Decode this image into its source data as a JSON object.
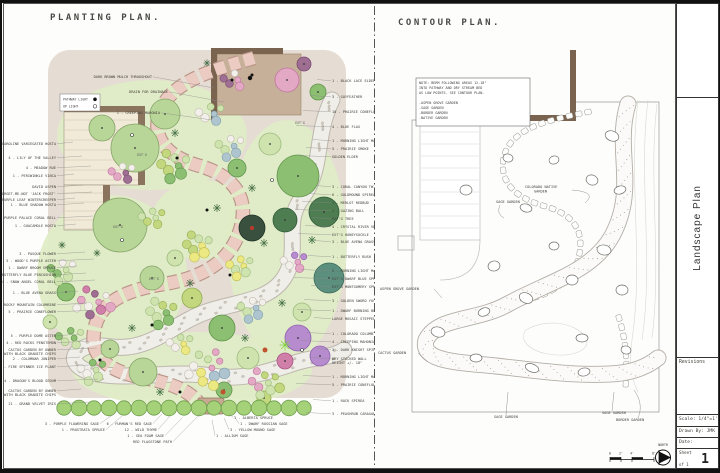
{
  "title_block": {
    "project": "Landscape Plan",
    "revisions_label": "Revisions",
    "scale_label": "Scale:  1/4\"=1'",
    "drawn_by_label": "Drawn By:  JMK",
    "date_label": "Date:",
    "sheet_label": "Sheet",
    "sheet_number": "1",
    "of_label": "of 1",
    "north_label": "NORTH",
    "scale_bar_labels": [
      "0",
      "2'",
      "4'",
      "8'"
    ]
  },
  "planting_plan": {
    "title": "PLANTING PLAN.",
    "legend": {
      "items": [
        {
          "label": "PATHWAY LIGHT",
          "symbol": "filled-dot"
        },
        {
          "label": "UP LIGHT",
          "symbol": "open-dot"
        }
      ]
    },
    "palette": {
      "aspen": [
        "#b9d699",
        "#85a468"
      ],
      "pale": [
        "#cfe3ae",
        "#9cbb7d"
      ],
      "mid": [
        "#8cbf72",
        "#5f9449"
      ],
      "deep": [
        "#4e7d52",
        "#2f5a38"
      ],
      "teal": [
        "#5d8f7e",
        "#3a6b5a"
      ],
      "ygreen": [
        "#c2d77e",
        "#93ad52"
      ],
      "yellow": [
        "#ece983",
        "#c2bb4f"
      ],
      "bgray": [
        "#aec4cf",
        "#7fa0b0"
      ],
      "pink": [
        "#e3a8c4",
        "#c075a0"
      ],
      "pinkDeep": [
        "#cf7fa8",
        "#a85585"
      ],
      "plum": [
        "#9f6f93",
        "#7a4a70"
      ],
      "purple": [
        "#b68cce",
        "#8f60ad"
      ],
      "white": [
        "#f3f0ec",
        "#c2bcb2"
      ],
      "ball": [
        "#39503f",
        "#1f3528"
      ],
      "hedge": [
        "#a5d178",
        "#6f9e4c"
      ]
    },
    "plants": [
      [
        133,
        108,
        24,
        "aspen"
      ],
      [
        163,
        74,
        15,
        "aspen"
      ],
      [
        100,
        88,
        13,
        "aspen"
      ],
      [
        118,
        185,
        27,
        "aspen"
      ],
      [
        150,
        238,
        12,
        "aspen"
      ],
      [
        141,
        332,
        14,
        "aspen"
      ],
      [
        108,
        309,
        9,
        "aspen"
      ],
      [
        296,
        136,
        21,
        "mid"
      ],
      [
        268,
        104,
        11,
        "pale"
      ],
      [
        322,
        172,
        15,
        "deep"
      ],
      [
        283,
        180,
        12,
        "deep"
      ],
      [
        327,
        238,
        15,
        "teal"
      ],
      [
        235,
        128,
        9,
        "mid"
      ],
      [
        250,
        188,
        13,
        "ball"
      ],
      [
        296,
        298,
        13,
        "purple"
      ],
      [
        318,
        316,
        10,
        "purple"
      ],
      [
        283,
        321,
        8,
        "pinkDeep"
      ],
      [
        300,
        272,
        9,
        "pale"
      ],
      [
        285,
        40,
        12,
        "pink"
      ],
      [
        302,
        24,
        7,
        "plum"
      ],
      [
        316,
        52,
        8,
        "mid"
      ],
      [
        220,
        288,
        13,
        "mid"
      ],
      [
        246,
        318,
        11,
        "pale"
      ],
      [
        190,
        258,
        10,
        "ygreen"
      ],
      [
        173,
        218,
        8,
        "pale"
      ],
      [
        64,
        252,
        9,
        "mid"
      ],
      [
        48,
        282,
        7,
        "pale"
      ],
      [
        222,
        350,
        8,
        "mid"
      ],
      [
        262,
        358,
        7,
        "ygreen"
      ]
    ],
    "clusters": [
      [
        208,
        74,
        6,
        13,
        3,
        5,
        [
          "bgray",
          "white",
          "pale"
        ]
      ],
      [
        172,
        126,
        8,
        17,
        3.5,
        6,
        [
          "mid",
          "ygreen",
          "pale"
        ]
      ],
      [
        228,
        106,
        7,
        14,
        3,
        5,
        [
          "bgray",
          "pale",
          "white"
        ]
      ],
      [
        196,
        206,
        8,
        15,
        3.5,
        5.5,
        [
          "yellow",
          "ygreen",
          "pale"
        ]
      ],
      [
        238,
        226,
        7,
        13,
        3,
        5,
        [
          "yellow",
          "pale"
        ]
      ],
      [
        92,
        262,
        10,
        19,
        3,
        5,
        [
          "pink",
          "white",
          "plum",
          "pinkDeep"
        ]
      ],
      [
        60,
        230,
        7,
        14,
        3,
        5,
        [
          "pale",
          "mid",
          "white"
        ]
      ],
      [
        160,
        273,
        8,
        16,
        3.5,
        5.5,
        [
          "mid",
          "pale",
          "ygreen"
        ]
      ],
      [
        205,
        328,
        12,
        22,
        3,
        5.5,
        [
          "pink",
          "yellow",
          "pale",
          "bgray",
          "white"
        ]
      ],
      [
        262,
        343,
        9,
        17,
        3,
        5,
        [
          "pale",
          "pink",
          "ygreen"
        ]
      ],
      [
        120,
        133,
        6,
        12,
        3,
        4.5,
        [
          "plum",
          "pink",
          "white"
        ]
      ],
      [
        250,
        268,
        7,
        14,
        3,
        5,
        [
          "bgray",
          "pale",
          "white"
        ]
      ],
      [
        178,
        304,
        6,
        12,
        3,
        4.5,
        [
          "yellow",
          "white",
          "pale"
        ]
      ],
      [
        68,
        298,
        6,
        13,
        3,
        4.5,
        [
          "mid",
          "pale"
        ]
      ],
      [
        232,
        40,
        5,
        11,
        3,
        4.5,
        [
          "pink",
          "plum",
          "white"
        ]
      ],
      [
        292,
        222,
        6,
        12,
        3,
        4.5,
        [
          "pink",
          "white",
          "purple"
        ]
      ],
      [
        150,
        178,
        6,
        12,
        3,
        4.5,
        [
          "pale",
          "ygreen"
        ]
      ],
      [
        90,
        330,
        7,
        14,
        3,
        5,
        [
          "pale",
          "white",
          "mid"
        ]
      ]
    ],
    "grass_stars": [
      [
        173,
        93,
        4
      ],
      [
        215,
        168,
        4
      ],
      [
        188,
        243,
        4
      ],
      [
        262,
        203,
        4
      ],
      [
        130,
        288,
        4
      ],
      [
        243,
        298,
        4
      ],
      [
        95,
        213,
        3.5
      ],
      [
        280,
        263,
        4
      ],
      [
        205,
        23,
        3.5
      ],
      [
        158,
        352,
        4
      ],
      [
        250,
        148,
        4
      ],
      [
        60,
        205,
        3.5
      ],
      [
        310,
        200,
        4
      ]
    ],
    "lime_stars": [
      [
        283,
        305,
        5.5
      ]
    ],
    "red_dots": [
      [
        263,
        310,
        2.5
      ],
      [
        221,
        352,
        2.5
      ]
    ],
    "hedge": {
      "count": 17,
      "x0": 62,
      "gap": 15,
      "y": 368,
      "r": 7.4
    },
    "flagstone_path": "M252,18 C210,30 168,42 158,72 C148,100 168,118 198,126 C232,136 248,158 238,190 C228,222 200,238 162,244 C124,250 96,262 92,292 C88,318 108,332 142,338 C168,343 186,350 196,362",
    "stream_path": "M330,60 C312,96 322,128 300,158 C280,184 300,210 282,238 C266,262 232,262 204,272 C176,282 160,300 132,306 C108,311 92,300 78,310 C66,318 74,330 96,334 C130,340 170,330 210,336 C244,341 270,330 296,322 C316,316 330,318 342,310",
    "pathway_lights": [
      [
        250,
        35
      ],
      [
        175,
        118
      ],
      [
        205,
        170
      ],
      [
        228,
        235
      ],
      [
        150,
        285
      ],
      [
        98,
        320
      ],
      [
        178,
        352
      ],
      [
        230,
        40
      ]
    ],
    "up_lights": [
      [
        130,
        95
      ],
      [
        120,
        200
      ],
      [
        270,
        140
      ],
      [
        300,
        310
      ]
    ],
    "inplan_notes": [
      {
        "x": 140,
        "y": 116,
        "t": "EXT'G"
      },
      {
        "x": 116,
        "y": 188,
        "t": "EXT'G"
      },
      {
        "x": 298,
        "y": 84,
        "t": "EXT'G"
      },
      {
        "x": 152,
        "y": 240,
        "t": "EXT'G"
      }
    ],
    "labels_top": [
      {
        "x": 150,
        "y": 38,
        "t": "DARK BROWN MULCH THROUGHOUT",
        "lx": 212,
        "ly": 48
      },
      {
        "x": 166,
        "y": 53,
        "t": "DRAIN FOR DRAINAGE",
        "lx": 222,
        "ly": 62
      },
      {
        "x": 158,
        "y": 74,
        "t": "1 - CREEPING MAHONIA",
        "lx": 210,
        "ly": 80
      }
    ],
    "labels_left": [
      {
        "y": 105,
        "t": "6 - CAROLINE VARIEGATED HOSTA"
      },
      {
        "y": 119,
        "t": "4 - LILY OF THE VALLEY"
      },
      {
        "y": 129,
        "t": "4 - MEADOW RUE"
      },
      {
        "y": 137,
        "t": "1 - PERIWINKLE VINCA"
      },
      {
        "y": 148,
        "t": "DAVID ASPEN"
      },
      {
        "y": 155,
        "t": "5 - FALSE FORGET-ME-NOT 'JACK FROST'"
      },
      {
        "y": 161,
        "t": "1 - PURPLE LEAF WINTERCREEPER"
      },
      {
        "y": 166,
        "t": "1 - BLUE SHADOW HOSTA"
      },
      {
        "y": 179,
        "t": "4 - PURPLE PALACE CORAL BELL"
      },
      {
        "y": 187,
        "t": "1 - GUACAMOLE HOSTA"
      },
      {
        "y": 215,
        "t": "3 - PASQUE FLOWER"
      },
      {
        "y": 222,
        "t": "5 - WOOD'S PURPLE ASTER"
      },
      {
        "y": 229,
        "t": "1 - DWARF BROOM SPRUCE"
      },
      {
        "y": 236,
        "t": "6 - BUTTERFLY BLUE PINCUSHION"
      },
      {
        "y": 243,
        "t": "4 - SNOW ANGEL CORAL BELL"
      },
      {
        "y": 254,
        "t": "1 - BLUE AVENA GRASS"
      },
      {
        "y": 266,
        "t": "6 - ROCKY MOUNTAIN COLUMBINE"
      },
      {
        "y": 273,
        "t": "5 - PRAIRIE CONEFLOWER"
      },
      {
        "y": 297,
        "t": "5 - PURPLE DOME ASTER"
      },
      {
        "y": 304,
        "t": "4 - RED ROCKS PENSTEMON"
      },
      {
        "y": 311,
        "t": "CACTUS GARDEN BY OWNER",
        "t2": "WITH BLACK GRANITE CHIPS"
      },
      {
        "y": 320,
        "t": "2 - COLUMNAR JUNIPER"
      },
      {
        "y": 328,
        "t": "5 - FIRE SPINNER ICE PLANT"
      },
      {
        "y": 342,
        "t": "4 - DRAGON'S BLOOD SEDUM"
      },
      {
        "y": 352,
        "t": "CACTUS GARDEN BY OWNER",
        "t2": "WITH BLACK GRANITE CHIPS"
      },
      {
        "y": 365,
        "t": "21 - GRAND VELVET IRIS"
      }
    ],
    "labels_right": [
      {
        "y": 42,
        "t": "1 - BLACK LACE ELDER"
      },
      {
        "y": 58,
        "t": "3 - GAYFEATHER"
      },
      {
        "y": 73,
        "t": "10 - PRAIRIE CONEFLOWER"
      },
      {
        "y": 88,
        "t": "4 - BLUE FLAX"
      },
      {
        "y": 102,
        "t": "1 - MORNING LIGHT MAIDEN GRASS"
      },
      {
        "y": 110,
        "t": "5 - PRAIRIE SMOKE"
      },
      {
        "y": 118,
        "t": "GOLDEN ELDER"
      },
      {
        "y": 148,
        "t": "3 - CORAL CANYON TWINSPUR"
      },
      {
        "y": 156,
        "t": "6 - GOLDMOUND SPIREA"
      },
      {
        "y": 164,
        "t": "1 - MERLOT REDBUD"
      },
      {
        "y": 172,
        "t": "1 - GAZING BALL"
      },
      {
        "y": 180,
        "t": "EXT'G TREE"
      },
      {
        "y": 188,
        "t": "4 - CRYSTAL RIVER VERONICA"
      },
      {
        "y": 196,
        "t": "EXT'G HONEYSUCKLE"
      },
      {
        "y": 203,
        "t": "3 - BLUE AVENA GRASS"
      },
      {
        "y": 218,
        "t": "1 - BUTTERFLY BUSH"
      },
      {
        "y": 232,
        "t": "5 - MORNING LIGHT MAIDEN GRASS"
      },
      {
        "y": 240,
        "t": "EXT'G DWARF BLUE SPRUCE"
      },
      {
        "y": 248,
        "t": "EXT'G MONTGOMERY SPRUCE"
      },
      {
        "y": 262,
        "t": "3 - GOLDEN SWORD YUCCA"
      },
      {
        "y": 272,
        "t": "1 - DWARF BURNING BUSH"
      },
      {
        "y": 280,
        "t": "LARGE MOSAIC STEPPER"
      },
      {
        "y": 295,
        "t": "1 - COLORADO COLUMBINE"
      },
      {
        "y": 303,
        "t": "4 - CREEPING MAHONIA"
      },
      {
        "y": 311,
        "t": "3 - DARK KNIGHT SPIREA"
      },
      {
        "y": 320,
        "t": "DRY STACKED WALL",
        "t2": "HEIGHT +/- 18\""
      },
      {
        "y": 338,
        "t": "1 - MORNING LIGHT MAIDEN GRASS"
      },
      {
        "y": 346,
        "t": "5 - PRAIRIE CONEFLOWER"
      },
      {
        "y": 362,
        "t": "1 - ROCK SPIREA"
      },
      {
        "y": 375,
        "t": "3 - PEASHRUB CARAGANA"
      }
    ],
    "labels_bottom": [
      {
        "x": 97,
        "y": 385,
        "t": "3 - PURPLE FLOWERING SAGE",
        "a": "end",
        "lx": 112,
        "ly": 374
      },
      {
        "x": 103,
        "y": 391,
        "t": "1 - PROSTRATA SPRUCE",
        "a": "end",
        "lx": 120,
        "ly": 376
      },
      {
        "x": 150,
        "y": 385,
        "t": "6 - FURMAN'S RED SAGE",
        "a": "end",
        "lx": 160,
        "ly": 374
      },
      {
        "x": 155,
        "y": 391,
        "t": "12 - WILD THYME",
        "a": "end",
        "lx": 168,
        "ly": 376
      },
      {
        "x": 162,
        "y": 397,
        "t": "1 - SEA FOAM SAGE",
        "a": "end",
        "lx": 180,
        "ly": 378
      },
      {
        "x": 170,
        "y": 403,
        "t": "RED FLAGSTONE PATH",
        "a": "end",
        "lx": 200,
        "ly": 372
      },
      {
        "x": 232,
        "y": 379,
        "t": "1 - ALBERTA SPRUCE",
        "a": "start",
        "lx": 228,
        "ly": 374
      },
      {
        "x": 238,
        "y": 385,
        "t": "1 - DWARF RUSSIAN SAGE",
        "a": "start",
        "lx": 232,
        "ly": 376
      },
      {
        "x": 228,
        "y": 391,
        "t": "3 - YELLOW MOUND SAGE",
        "a": "start",
        "lx": 222,
        "ly": 378
      },
      {
        "x": 214,
        "y": 397,
        "t": "1 - ALLIUM SAGE",
        "a": "start",
        "lx": 210,
        "ly": 380
      }
    ]
  },
  "contour_plan": {
    "title": "CONTOUR PLAN.",
    "note_lines": [
      "NOTE:  BERM FOLLOWING AREAS 12-18\"",
      "INTO PATHWAY AND DRY STREAM BED",
      "AS LOW POINTS. SEE CONTOUR PLAN.",
      "",
      "-ASPEN GROVE GARDEN",
      "-SAGE GARDEN",
      "-BORDER GARDEN",
      "-NATIVE GARDEN"
    ],
    "stream_path": "M252,64 C238,110 262,148 236,196 C216,232 172,242 132,264 C100,282 62,276 50,300 C44,322 82,322 120,326 C156,330 196,336 234,334 C258,333 272,326 282,318",
    "stone_chains": [
      "M212,72 C172,80 136,88 128,116 C122,142 140,158 168,166 C198,174 210,192 202,220 C194,246 168,258 134,263",
      "M243,278 C250,300 252,325 249,352"
    ],
    "contour_lines": [
      "M262,60 C252,140 268,220 256,300 C252,330 258,344 262,352",
      "M272,60 C262,140 278,220 266,300",
      "M281,64 C272,140 286,220 276,298",
      "M150,290 C170,278 200,282 210,298 C216,310 196,318 172,314 C154,311 142,300 150,290"
    ],
    "boulders": [
      [
        236,
        96,
        7,
        5,
        20
      ],
      [
        244,
        150,
        6,
        4,
        -15
      ],
      [
        228,
        210,
        7,
        5,
        10
      ],
      [
        196,
        240,
        6,
        5,
        0
      ],
      [
        150,
        258,
        7,
        5,
        25
      ],
      [
        108,
        272,
        6,
        4,
        -20
      ],
      [
        62,
        292,
        7,
        5,
        15
      ],
      [
        100,
        318,
        6,
        4,
        0
      ],
      [
        156,
        328,
        7,
        4,
        20
      ],
      [
        208,
        332,
        6,
        4,
        -10
      ],
      [
        90,
        150,
        6,
        5,
        0
      ],
      [
        150,
        168,
        6,
        4,
        15
      ],
      [
        118,
        226,
        6,
        5,
        -10
      ],
      [
        178,
        206,
        5,
        4,
        0
      ],
      [
        216,
        140,
        6,
        5,
        20
      ],
      [
        246,
        250,
        6,
        5,
        0
      ],
      [
        132,
        118,
        5,
        4,
        10
      ],
      [
        178,
        120,
        5,
        4,
        -15
      ],
      [
        206,
        298,
        6,
        4,
        0
      ],
      [
        250,
        310,
        5,
        4,
        12
      ]
    ],
    "labels": [
      {
        "x": 149,
        "y": 148,
        "t": "COLORADO NATIVE",
        "a": "start",
        "leader": "M196,150 Q222,152 209,163"
      },
      {
        "x": 158,
        "y": 152.5,
        "t": "GARDEN",
        "a": "start"
      },
      {
        "x": 120,
        "y": 163,
        "t": "SAGE GARDEN",
        "a": "start",
        "leader": "M124,165 Q120,174 128,178"
      },
      {
        "x": 4,
        "y": 250,
        "t": "ASPEN GROVE GARDEN",
        "a": "start",
        "leader": "M58,249 L66,258"
      },
      {
        "x": 2,
        "y": 314,
        "t": "CACTUS GARDEN",
        "a": "start",
        "leader": "M42,313 L52,322"
      },
      {
        "x": 118,
        "y": 378,
        "t": "SAGE GARDEN",
        "a": "start",
        "leader": "M130,375 L132,352"
      },
      {
        "x": 226,
        "y": 374,
        "t": "SAGE GARDEN",
        "a": "start",
        "leader": "M236,371 L238,352"
      },
      {
        "x": 240,
        "y": 381,
        "t": "BORDER GARDEN",
        "a": "start",
        "leader": "M262,378 Q268,364 258,350"
      }
    ]
  }
}
